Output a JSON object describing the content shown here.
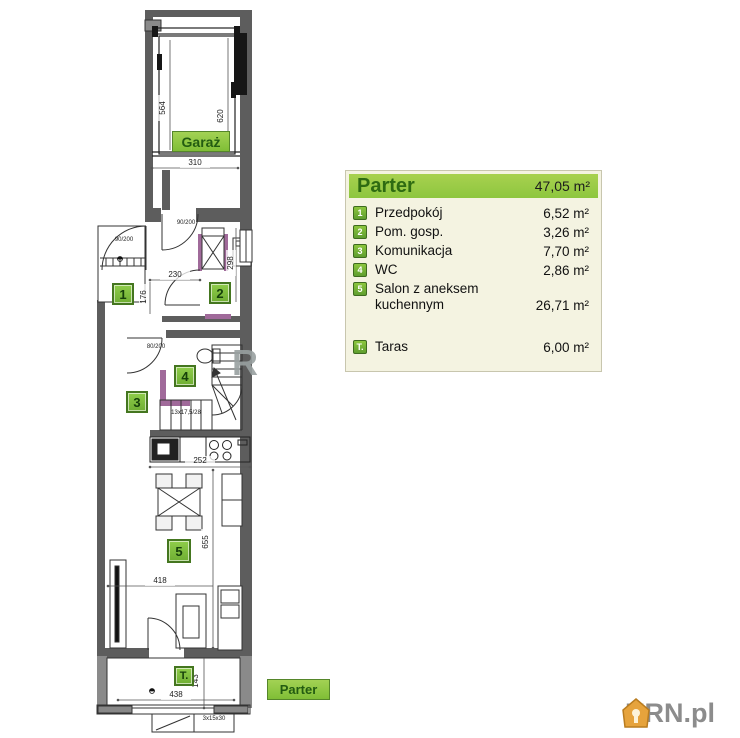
{
  "legend": {
    "title": "Parter",
    "total_area": "47,05 m²",
    "rows": [
      {
        "num": "1",
        "label": "Przedpokój",
        "area": "6,52 m²"
      },
      {
        "num": "2",
        "label": "Pom. gosp.",
        "area": "3,26 m²"
      },
      {
        "num": "3",
        "label": "Komunikacja",
        "area": "7,70 m²"
      },
      {
        "num": "4",
        "label": "WC",
        "area": "2,86 m²"
      },
      {
        "num": "5",
        "label": "Salon z aneksem kuchennym",
        "area": "26,71 m²"
      }
    ],
    "taras": {
      "num": "T.",
      "label": "Taras",
      "area": "6,00 m²"
    }
  },
  "plan": {
    "garage_label": "Garaż",
    "floor_tag": "Parter",
    "badges": {
      "b1": "1",
      "b2": "2",
      "b3": "3",
      "b4": "4",
      "b5": "5",
      "bt": "T."
    },
    "dims": {
      "garage_depth_left": "564",
      "garage_depth_right": "620",
      "garage_width": "310",
      "hall_width": "230",
      "hall_depth": "176",
      "room2_depth": "298",
      "kitchen_width": "252",
      "salon_depth": "655",
      "salon_width": "418",
      "terrace_width": "438",
      "terrace_depth": "143",
      "door_garage": "90/200",
      "door_entry": "90/200",
      "door_wc": "80/200",
      "stairs": "13x17,5/28",
      "ext_steps": "3x15x30"
    }
  },
  "watermark": "R",
  "logo": {
    "text": "KRN.pl"
  },
  "colors": {
    "wall": "#5d5d5d",
    "accent_purple": "#a06a9a",
    "legend_green": "#8dc63f",
    "badge_green": "#7dc242",
    "logo_orange": "#e6a33c"
  }
}
